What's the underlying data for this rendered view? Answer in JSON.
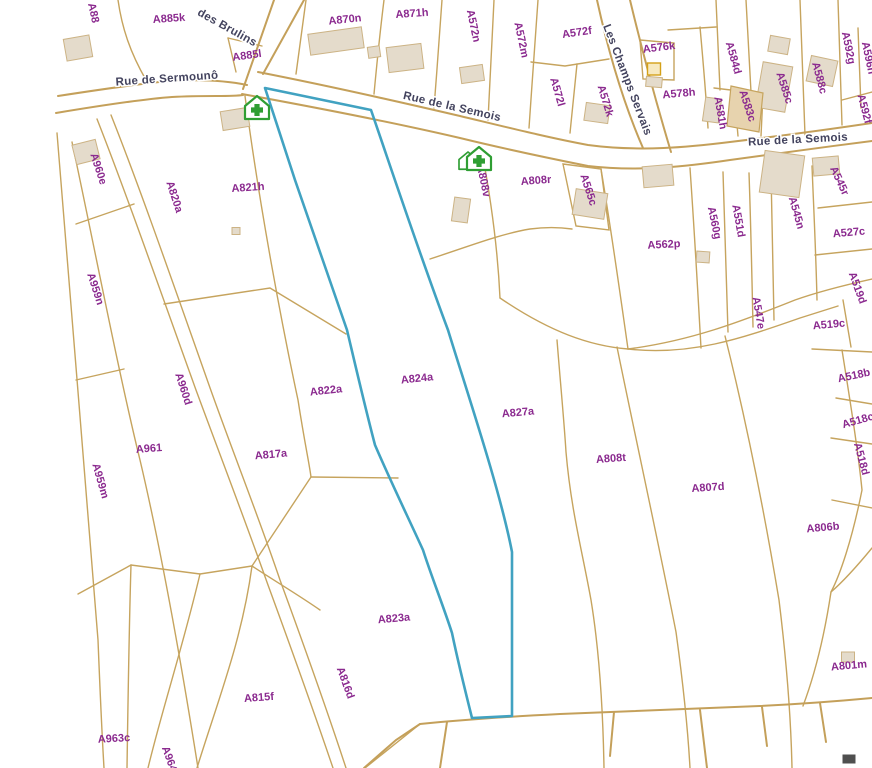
{
  "map": {
    "type": "cadastral-parcel-map",
    "highlighted_parcel": "A824a",
    "colors": {
      "background": "#ffffff",
      "parcel_line": "#c6a45e",
      "road_line": "#c4a05a",
      "parcel_label": "#8b2a8f",
      "street_label": "#43435e",
      "highlight_outline": "#41a2c1",
      "building_fill": "#e4dbcb",
      "poi_green": "#2f9e33"
    },
    "street_labels": [
      {
        "name": "des Brulins",
        "x": 227,
        "y": 28,
        "rot": 29
      },
      {
        "name": "Rue de Sermounô",
        "x": 167,
        "y": 79,
        "rot": -4
      },
      {
        "name": "Rue de la Semois",
        "x": 452,
        "y": 107,
        "rot": 13
      },
      {
        "name": "Rue de la Semois",
        "x": 798,
        "y": 140,
        "rot": -3
      },
      {
        "name": "Les Champs Servais",
        "x": 627,
        "y": 80,
        "rot": 69
      }
    ],
    "parcel_labels": [
      {
        "id": "A88",
        "x": 93,
        "y": 13,
        "rot": 78
      },
      {
        "id": "A885k",
        "x": 169,
        "y": 19,
        "rot": -4
      },
      {
        "id": "A885l",
        "x": 247,
        "y": 56,
        "rot": -8
      },
      {
        "id": "A870n",
        "x": 345,
        "y": 20,
        "rot": -6
      },
      {
        "id": "A871h",
        "x": 412,
        "y": 14,
        "rot": -4
      },
      {
        "id": "A572n",
        "x": 473,
        "y": 26,
        "rot": 78
      },
      {
        "id": "A572m",
        "x": 521,
        "y": 40,
        "rot": 78
      },
      {
        "id": "A572f",
        "x": 577,
        "y": 33,
        "rot": -8
      },
      {
        "id": "A572l",
        "x": 557,
        "y": 92,
        "rot": 74
      },
      {
        "id": "A572k",
        "x": 605,
        "y": 101,
        "rot": 73
      },
      {
        "id": "A576k",
        "x": 659,
        "y": 48,
        "rot": -7
      },
      {
        "id": "A578h",
        "x": 679,
        "y": 94,
        "rot": -5
      },
      {
        "id": "A584d",
        "x": 733,
        "y": 58,
        "rot": 74
      },
      {
        "id": "A581h",
        "x": 720,
        "y": 113,
        "rot": 80
      },
      {
        "id": "A583c",
        "x": 747,
        "y": 106,
        "rot": 72
      },
      {
        "id": "A585c",
        "x": 784,
        "y": 88,
        "rot": 72
      },
      {
        "id": "A588c",
        "x": 819,
        "y": 78,
        "rot": 75
      },
      {
        "id": "A592g",
        "x": 848,
        "y": 48,
        "rot": 78
      },
      {
        "id": "A596h",
        "x": 868,
        "y": 58,
        "rot": 78
      },
      {
        "id": "A592f",
        "x": 864,
        "y": 109,
        "rot": 75
      },
      {
        "id": "A545r",
        "x": 839,
        "y": 181,
        "rot": 65
      },
      {
        "id": "A808v",
        "x": 483,
        "y": 181,
        "rot": 78
      },
      {
        "id": "A808r",
        "x": 536,
        "y": 181,
        "rot": -4
      },
      {
        "id": "A565c",
        "x": 588,
        "y": 190,
        "rot": 72
      },
      {
        "id": "A562p",
        "x": 664,
        "y": 245,
        "rot": -3
      },
      {
        "id": "A560g",
        "x": 714,
        "y": 223,
        "rot": 78
      },
      {
        "id": "A551d",
        "x": 738,
        "y": 221,
        "rot": 80
      },
      {
        "id": "A545n",
        "x": 796,
        "y": 213,
        "rot": 74
      },
      {
        "id": "A527c",
        "x": 849,
        "y": 233,
        "rot": -5
      },
      {
        "id": "A547e",
        "x": 758,
        "y": 313,
        "rot": 80
      },
      {
        "id": "A519d",
        "x": 857,
        "y": 288,
        "rot": 70
      },
      {
        "id": "A519c",
        "x": 829,
        "y": 325,
        "rot": -5
      },
      {
        "id": "A518b",
        "x": 854,
        "y": 376,
        "rot": -12
      },
      {
        "id": "A518c",
        "x": 858,
        "y": 421,
        "rot": -16
      },
      {
        "id": "A518d",
        "x": 861,
        "y": 459,
        "rot": 75
      },
      {
        "id": "A806b",
        "x": 823,
        "y": 528,
        "rot": -5
      },
      {
        "id": "A807d",
        "x": 708,
        "y": 488,
        "rot": -4
      },
      {
        "id": "A808t",
        "x": 611,
        "y": 459,
        "rot": -4
      },
      {
        "id": "A827a",
        "x": 518,
        "y": 413,
        "rot": -5
      },
      {
        "id": "A824a",
        "x": 417,
        "y": 379,
        "rot": -6
      },
      {
        "id": "A822a",
        "x": 326,
        "y": 391,
        "rot": -6
      },
      {
        "id": "A821h",
        "x": 248,
        "y": 188,
        "rot": -4
      },
      {
        "id": "A820a",
        "x": 174,
        "y": 197,
        "rot": 72
      },
      {
        "id": "A960e",
        "x": 98,
        "y": 169,
        "rot": 72
      },
      {
        "id": "A959n",
        "x": 95,
        "y": 289,
        "rot": 72
      },
      {
        "id": "A959m",
        "x": 100,
        "y": 481,
        "rot": 74
      },
      {
        "id": "A960d",
        "x": 183,
        "y": 389,
        "rot": 72
      },
      {
        "id": "A961",
        "x": 149,
        "y": 449,
        "rot": -4
      },
      {
        "id": "A817a",
        "x": 271,
        "y": 455,
        "rot": -5
      },
      {
        "id": "A823a",
        "x": 394,
        "y": 619,
        "rot": -5
      },
      {
        "id": "A816d",
        "x": 345,
        "y": 683,
        "rot": 70
      },
      {
        "id": "A815f",
        "x": 259,
        "y": 698,
        "rot": -4
      },
      {
        "id": "A963c",
        "x": 114,
        "y": 739,
        "rot": -3
      },
      {
        "id": "A964e",
        "x": 170,
        "y": 762,
        "rot": 70
      },
      {
        "id": "A801m",
        "x": 849,
        "y": 666,
        "rot": -5
      }
    ],
    "pois": [
      {
        "icon": "green-house-cross-icon",
        "x": 257,
        "y": 108,
        "variant": "single"
      },
      {
        "icon": "green-house-cross-icon",
        "x": 477,
        "y": 159,
        "variant": "double"
      }
    ]
  }
}
